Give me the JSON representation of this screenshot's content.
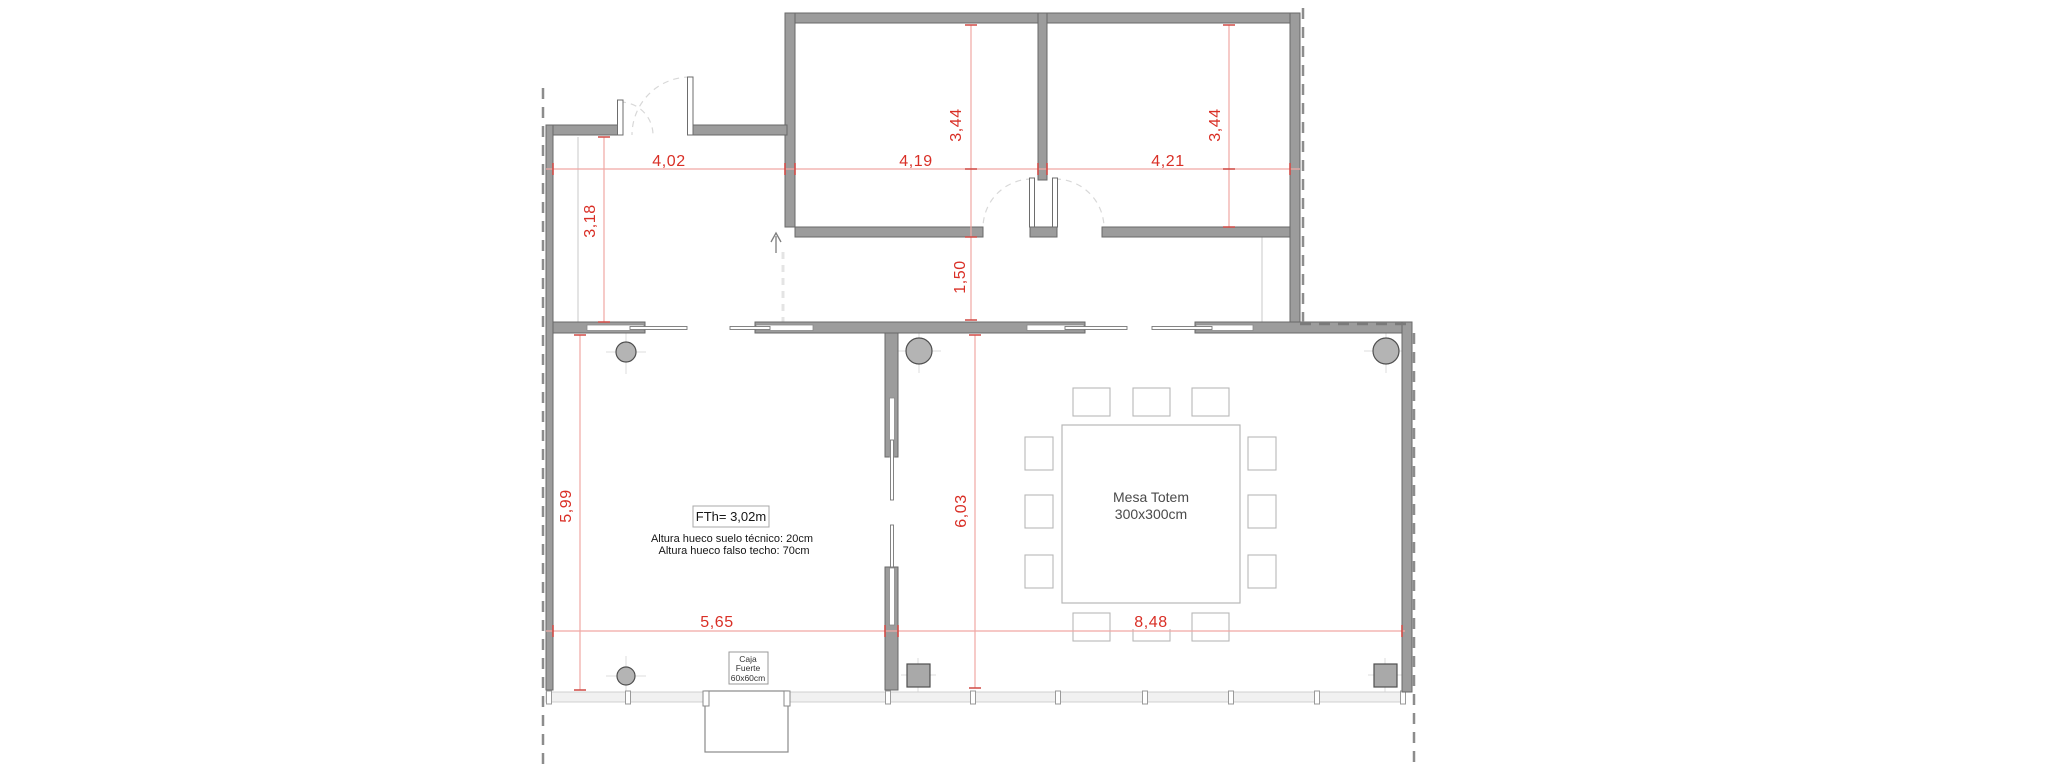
{
  "plan": {
    "dimensions": {
      "d_402": "4,02",
      "d_419": "4,19",
      "d_421": "4,21",
      "d_344a": "3,44",
      "d_344b": "3,44",
      "d_318": "3,18",
      "d_150": "1,50",
      "d_599": "5,99",
      "d_603": "6,03",
      "d_565": "5,65",
      "d_848": "8,48"
    },
    "annotations": {
      "fth": "FTh= 3,02m",
      "note1": "Altura hueco suelo técnico: 20cm",
      "note2": "Altura hueco falso techo: 70cm"
    },
    "furniture": {
      "table_line1": "Mesa Totem",
      "table_line2": "300x300cm",
      "safe_line1": "Caja",
      "safe_line2": "Fuerte",
      "safe_line3": "60x60cm"
    },
    "colors": {
      "wall_fill": "#9c9c9c",
      "wall_stroke": "#696969",
      "dimension_text": "#d92f26",
      "dimension_line": "#f0a8a4",
      "boundary_dash": "#8c8c8c",
      "furniture_stroke": "#b8b8b8",
      "facade_fill": "#f1f1f1"
    }
  }
}
